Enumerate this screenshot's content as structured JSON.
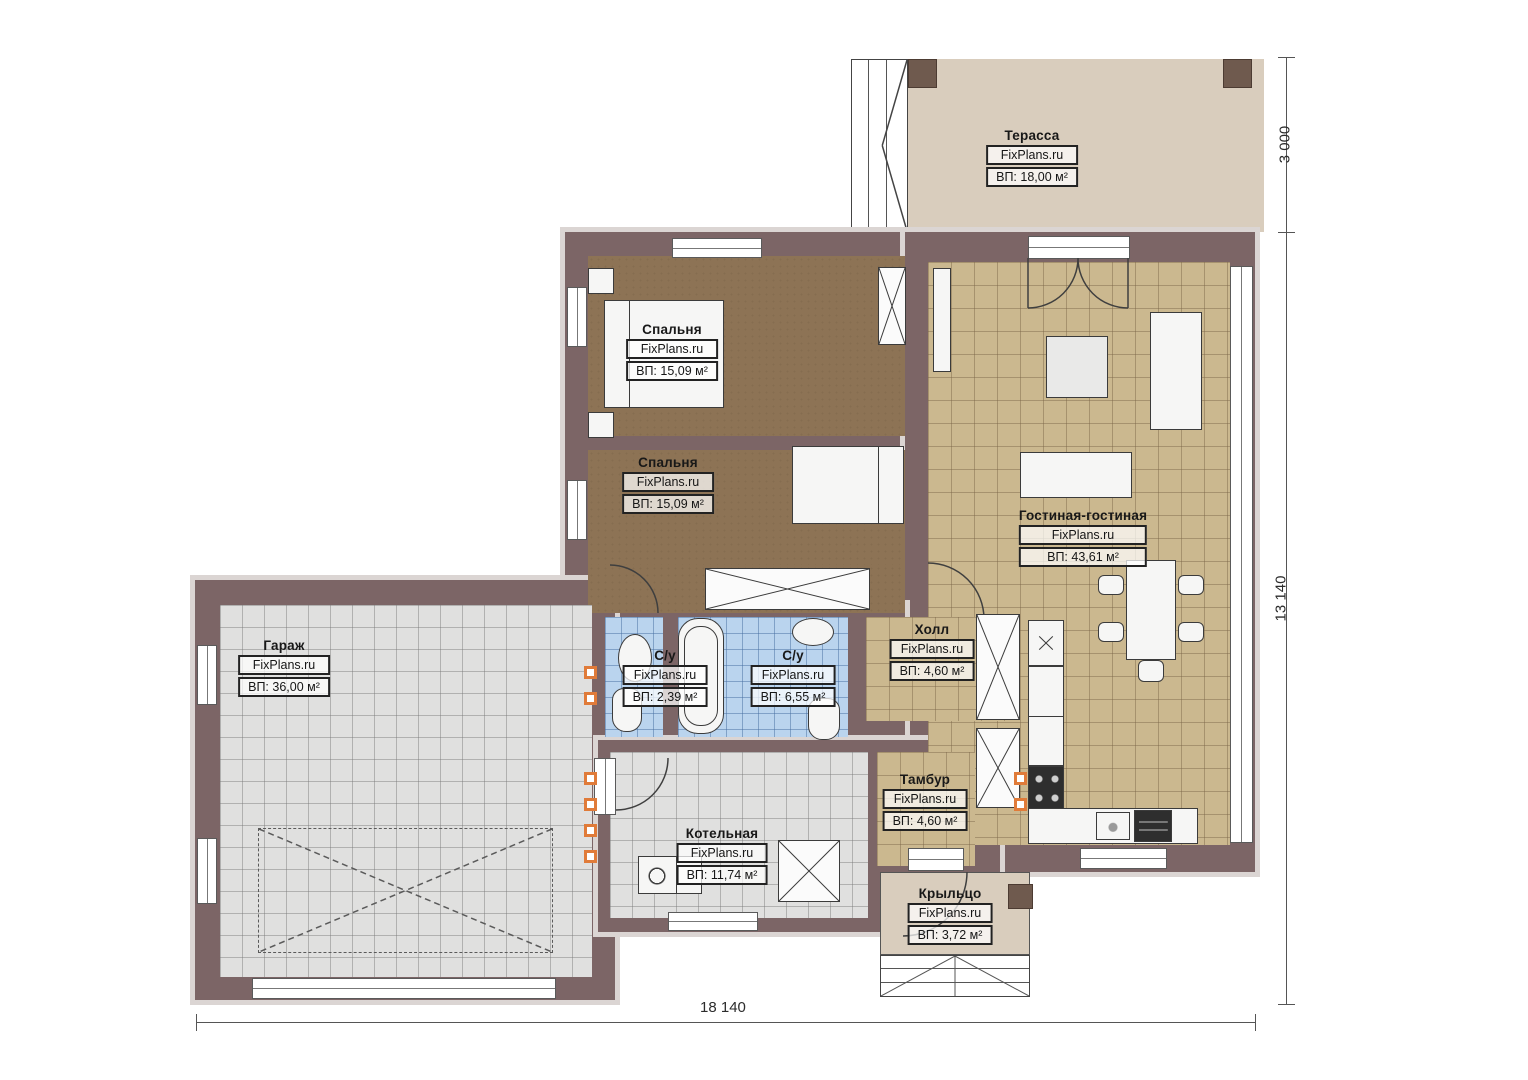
{
  "brand": "FixPlans.ru",
  "dimensions": {
    "right_top": "3 000",
    "right_main": "13 140",
    "bottom": "18 140"
  },
  "rooms": [
    {
      "name": "Терасса",
      "area": "ВП: 18,00 м²"
    },
    {
      "name": "Спальня",
      "area": "ВП: 15,09 м²"
    },
    {
      "name": "Спальня",
      "area": "ВП: 15,09 м²"
    },
    {
      "name": "Гостиная-гостиная",
      "area": "ВП: 43,61 м²"
    },
    {
      "name": "Холл",
      "area": "ВП: 4,60 м²"
    },
    {
      "name": "С/у",
      "area": "ВП: 2,39 м²"
    },
    {
      "name": "С/у",
      "area": "ВП: 6,55 м²"
    },
    {
      "name": "Гараж",
      "area": "ВП: 36,00 м²"
    },
    {
      "name": "Тамбур",
      "area": "ВП: 4,60 м²"
    },
    {
      "name": "Котельная",
      "area": "ВП: 11,74 м²"
    },
    {
      "name": "Крыльцо",
      "area": "ВП: 3,72 м²"
    }
  ],
  "colors": {
    "wall": "#7c6566",
    "wall_outline": "#dbd5d3",
    "floor_bedroom": "#8d7355",
    "floor_living_tiles": "#cbb88f",
    "floor_bath_tiles": "#bad4ee",
    "floor_garage_tiles": "#e0e0df",
    "floor_terrace": "#d9cdbd",
    "vent_accent": "#e07b39"
  }
}
